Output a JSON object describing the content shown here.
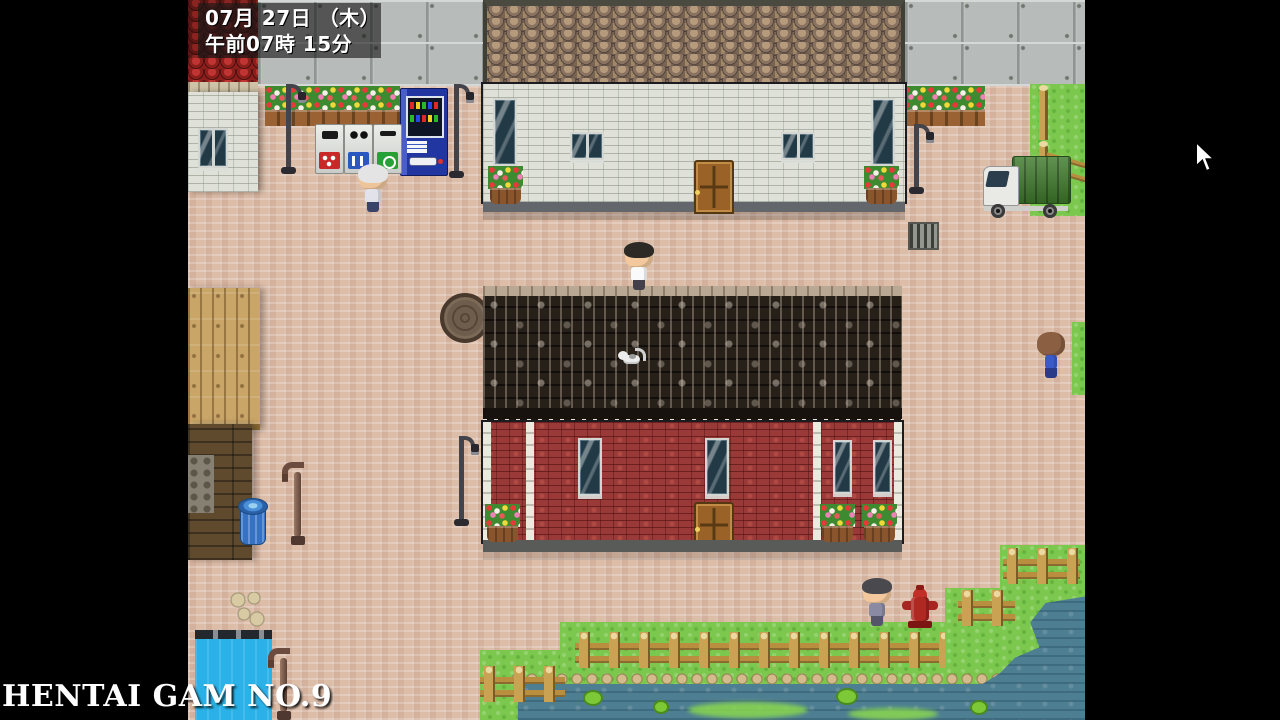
{
  "hud": {
    "date_line": "07月 27日 （木）",
    "time_line": "午前07時 15分"
  },
  "watermark_text": "HENTAI GAM NO.9",
  "colors": {
    "letterbox": "#000000",
    "hud_bg": "rgba(22,22,22,0.62)",
    "pavement": "#dcbda8",
    "grass": "#7cc84e",
    "pond_water": "#4d7e92",
    "pool_blue": "#2ab2e8",
    "red_brick": "#9a3a38",
    "grey_brick": "#dfe1d8",
    "dark_roof": "#262019",
    "scallop_roof": "#8a7260",
    "vending_blue": "#2236a2",
    "truck_green": "#3e7a2c",
    "hydrant_red": "#b02822",
    "fence_wood": "#c9a254"
  }
}
